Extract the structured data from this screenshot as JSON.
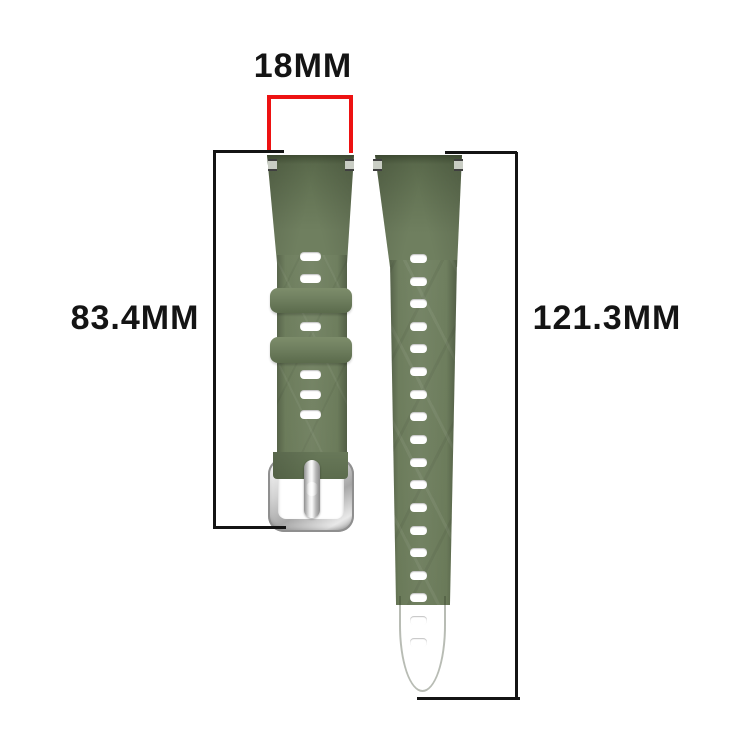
{
  "page": {
    "description": "Watch band size diagram with dimension annotations",
    "background": "#ffffff"
  },
  "labels": {
    "lug_width": "18MM",
    "short_strap_length": "83.4MM",
    "long_strap_length": "121.3MM"
  },
  "colors": {
    "strap_green": "#6f7f5f",
    "strap_green_dark": "#5b6b4c",
    "strap_green_light": "#7d8d6b",
    "buckle_silver": "#d6d6d6",
    "dimension_red": "#ed1212",
    "dimension_black": "#141414",
    "hole_white": "#ffffff"
  },
  "short_strap": {
    "name": "buckle strap",
    "slot_centers_y": [
      256,
      278,
      326,
      374,
      394,
      414
    ],
    "keepers": [
      {
        "top": 288,
        "height": 25
      },
      {
        "top": 337,
        "height": 26
      }
    ]
  },
  "long_strap": {
    "name": "hole strap",
    "hole_centers_y": [
      258,
      281,
      303,
      326,
      348,
      371,
      394,
      416,
      439,
      462,
      484,
      507,
      530,
      552,
      575,
      597,
      620,
      642
    ]
  }
}
